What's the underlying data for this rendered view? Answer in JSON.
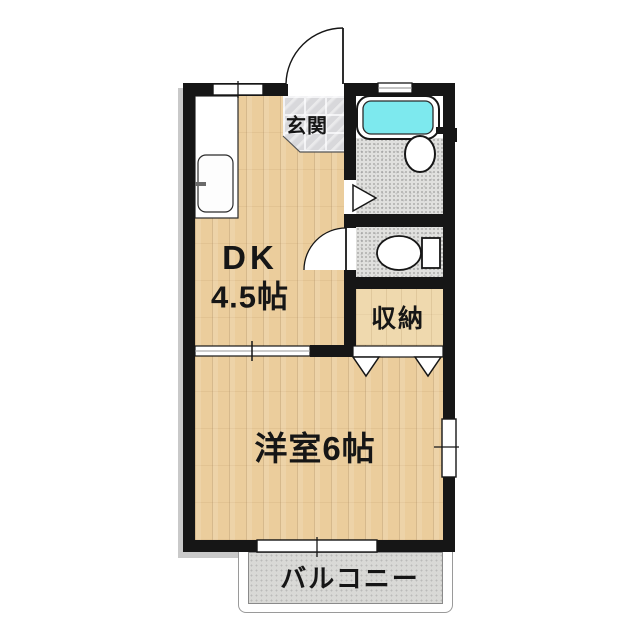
{
  "plan": {
    "type": "apartment-floor-plan",
    "rooms": {
      "genkan": {
        "label": "玄関"
      },
      "dk": {
        "name": "DK",
        "size": "4.5帖"
      },
      "closet": {
        "label": "収納"
      },
      "western_room": {
        "label": "洋室6帖"
      },
      "balcony": {
        "label": "バルコニー"
      }
    },
    "fixtures": {
      "bathtub": "bathtub",
      "washbasin": "round-washbasin",
      "toilet": "toilet-with-tank",
      "kitchen_sink": "kitchen-sink-counter",
      "entrance_door": "swing-door",
      "toilet_door": "swing-door",
      "bath_door": "folding-door",
      "closet_door": "bifold-door",
      "dk_room_divider": "sliding-door",
      "windows": [
        "top-left-window",
        "bath-vent-window",
        "right-wall-window",
        "balcony-sliding-window"
      ]
    },
    "colors": {
      "wall": "#161616",
      "bathtub_water": "#7DE9EE",
      "wood_floor": "#EBCD9C",
      "tile_floor": "#D8D8DB",
      "wet_area_floor": "#E0E0DE",
      "balcony_floor": "#D9D9D6",
      "background": "#FFFFFF"
    }
  }
}
